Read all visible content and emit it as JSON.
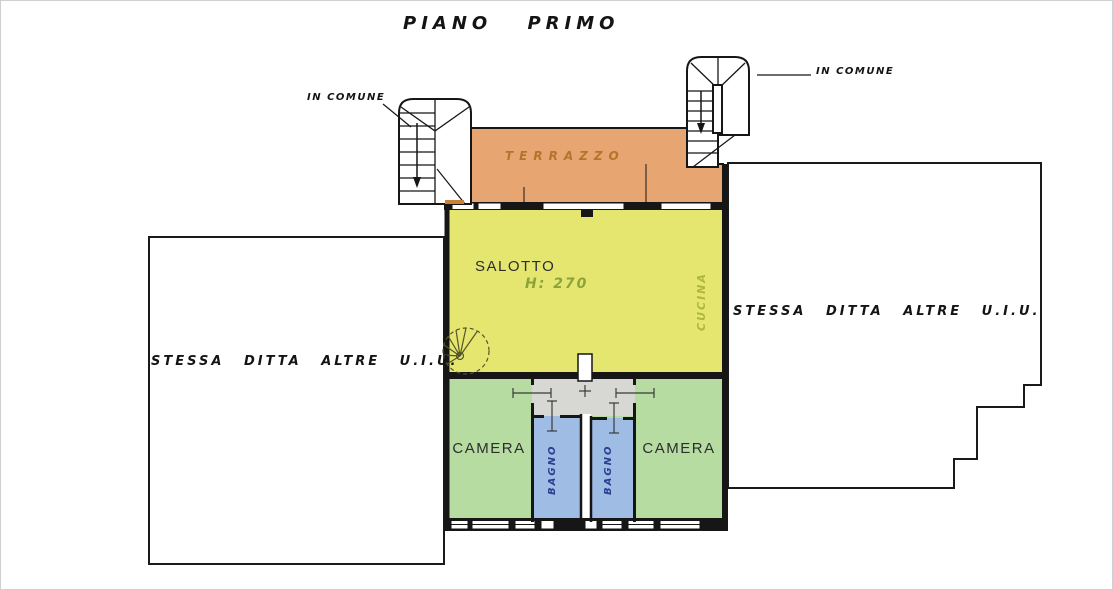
{
  "title": "PIANO PRIMO",
  "annotations": {
    "stair_left_label": "IN COMUNE",
    "stair_right_label": "IN COMUNE",
    "area_left_label": "STESSA DITTA ALTRE U.I.U.",
    "area_right_label": "STESSA DITTA ALTRE U.I.U."
  },
  "rooms": {
    "terrace": {
      "label": "TERRAZZO",
      "color": "#E7A671"
    },
    "living": {
      "label": "SALOTTO",
      "height_note": "H: 270",
      "color": "#E4E66F"
    },
    "kitchen": {
      "label": "CUCINA"
    },
    "bedroom_left": {
      "label": "CAMERA",
      "color": "#B6DCA2"
    },
    "bedroom_right": {
      "label": "CAMERA",
      "color": "#B6DCA2"
    },
    "bath_left": {
      "label": "BAGNO",
      "color": "#9FBCE4"
    },
    "bath_right": {
      "label": "BAGNO",
      "color": "#9FBCE4"
    },
    "hallway": {
      "color": "#D7D7D3"
    }
  },
  "colors": {
    "wall": "#161616",
    "terrace_text": "#B5742C",
    "height_text": "#8DA33A",
    "kitchen_text": "#AFB73B",
    "bath_text": "#2A3F8E",
    "outline": "#1A1A1A"
  }
}
